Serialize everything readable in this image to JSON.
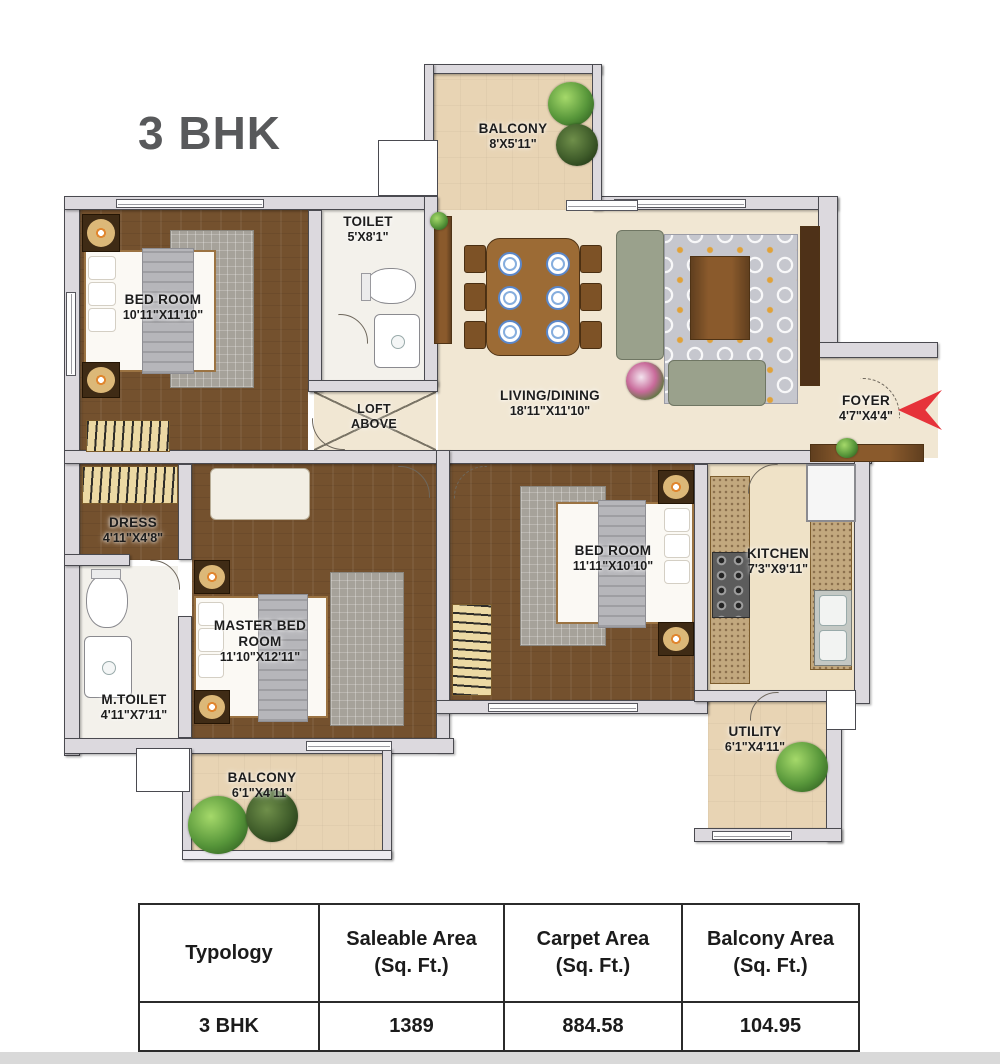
{
  "title": "3 BHK",
  "rooms": {
    "balcony_top": {
      "name": "BALCONY",
      "dims": "8'X5'11\""
    },
    "toilet": {
      "name": "TOILET",
      "dims": "5'X8'1\""
    },
    "bedroom1": {
      "name": "BED ROOM",
      "dims": "10'11\"X11'10\""
    },
    "living": {
      "name": "LIVING/DINING",
      "dims": "18'11\"X11'10\""
    },
    "loft": {
      "name": "LOFT ABOVE",
      "dims": ""
    },
    "foyer": {
      "name": "FOYER",
      "dims": "4'7\"X4'4\""
    },
    "dress": {
      "name": "DRESS",
      "dims": "4'11\"X4'8\""
    },
    "m_toilet": {
      "name": "M.TOILET",
      "dims": "4'11\"X7'11\""
    },
    "master_bedroom": {
      "name": "MASTER BED ROOM",
      "dims": "11'10\"X12'11\""
    },
    "bedroom2": {
      "name": "BED ROOM",
      "dims": "11'11\"X10'10\""
    },
    "kitchen": {
      "name": "KITCHEN",
      "dims": "7'3\"X9'11\""
    },
    "utility": {
      "name": "UTILITY",
      "dims": "6'1\"X4'11\""
    },
    "balcony_bottom": {
      "name": "BALCONY",
      "dims": "6'1\"X4'11\""
    }
  },
  "table": {
    "columns": [
      {
        "label": "Typology",
        "unit": ""
      },
      {
        "label": "Saleable Area",
        "unit": "(Sq. Ft.)"
      },
      {
        "label": "Carpet Area",
        "unit": "(Sq. Ft.)"
      },
      {
        "label": "Balcony Area",
        "unit": "(Sq. Ft.)"
      }
    ],
    "row": [
      "3 BHK",
      "1389",
      "884.58",
      "104.95"
    ]
  },
  "colors": {
    "wall": "#dcd9de",
    "wood_floor": "#74512e",
    "living_floor": "#f1e7d3",
    "balcony_floor": "#e8d4b4",
    "entry_arrow": "#e6333a",
    "title_text": "#58595b"
  }
}
